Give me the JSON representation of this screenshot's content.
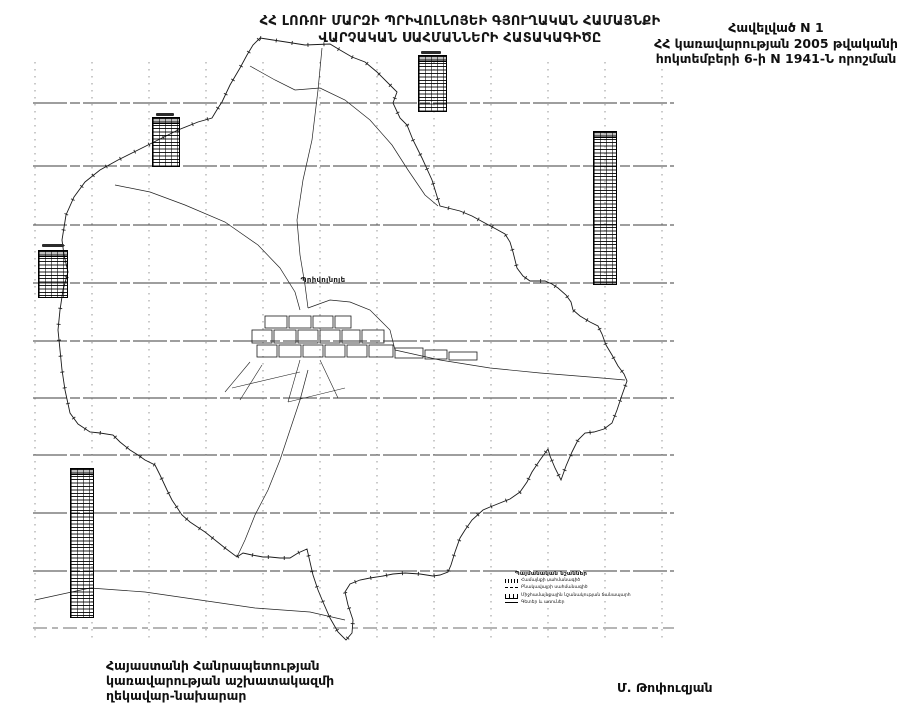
{
  "document": {
    "title_line1": "ՀՀ ԼՈՌՈՒ ՄԱՐԶԻ ՊՐԻՎՈԼՆՈՅԵԻ ԳՅՈՒՂԱԿԱՆ ՀԱՄԱՅՆՔԻ",
    "title_line2": "ՎԱՐՉԱԿԱՆ ՍԱՀՄԱՆՆԵՐԻ ՀԱՏԱԿԱԳԻԾԸ",
    "annex": {
      "line1": "Հավելված N 1",
      "line2": "ՀՀ կառավարության 2005 թվականի",
      "line3": "հոկտեմբերի 6-ի N 1941-Ն որոշման"
    },
    "signature": {
      "line1": "Հայաստանի Հանրապետության",
      "line2": "կառավարության աշխատակազմի",
      "line3": "ղեկավար-նախարար",
      "signer": "Մ. Թոփուզյան"
    }
  },
  "map": {
    "settlement_label": "Պրիվոլնոյե",
    "coordinate_tables_count": 5,
    "legend": {
      "title": "Պայմանական նշաններ",
      "items": [
        {
          "symbol": "hatched-line",
          "label": "Համայնքի սահմանագիծ"
        },
        {
          "symbol": "dashed-line",
          "label": "Բնակավայրի սահմանագիծ"
        },
        {
          "symbol": "cross-tick-line",
          "label": "Միջհամայնքային նշանակության ճանապարհ"
        },
        {
          "symbol": "thin-line",
          "label": "Գետեր և առուներ"
        }
      ]
    },
    "colors": {
      "ink": "#1a1a1a",
      "grid": "#4a4a4a",
      "paper": "#ffffff"
    }
  }
}
